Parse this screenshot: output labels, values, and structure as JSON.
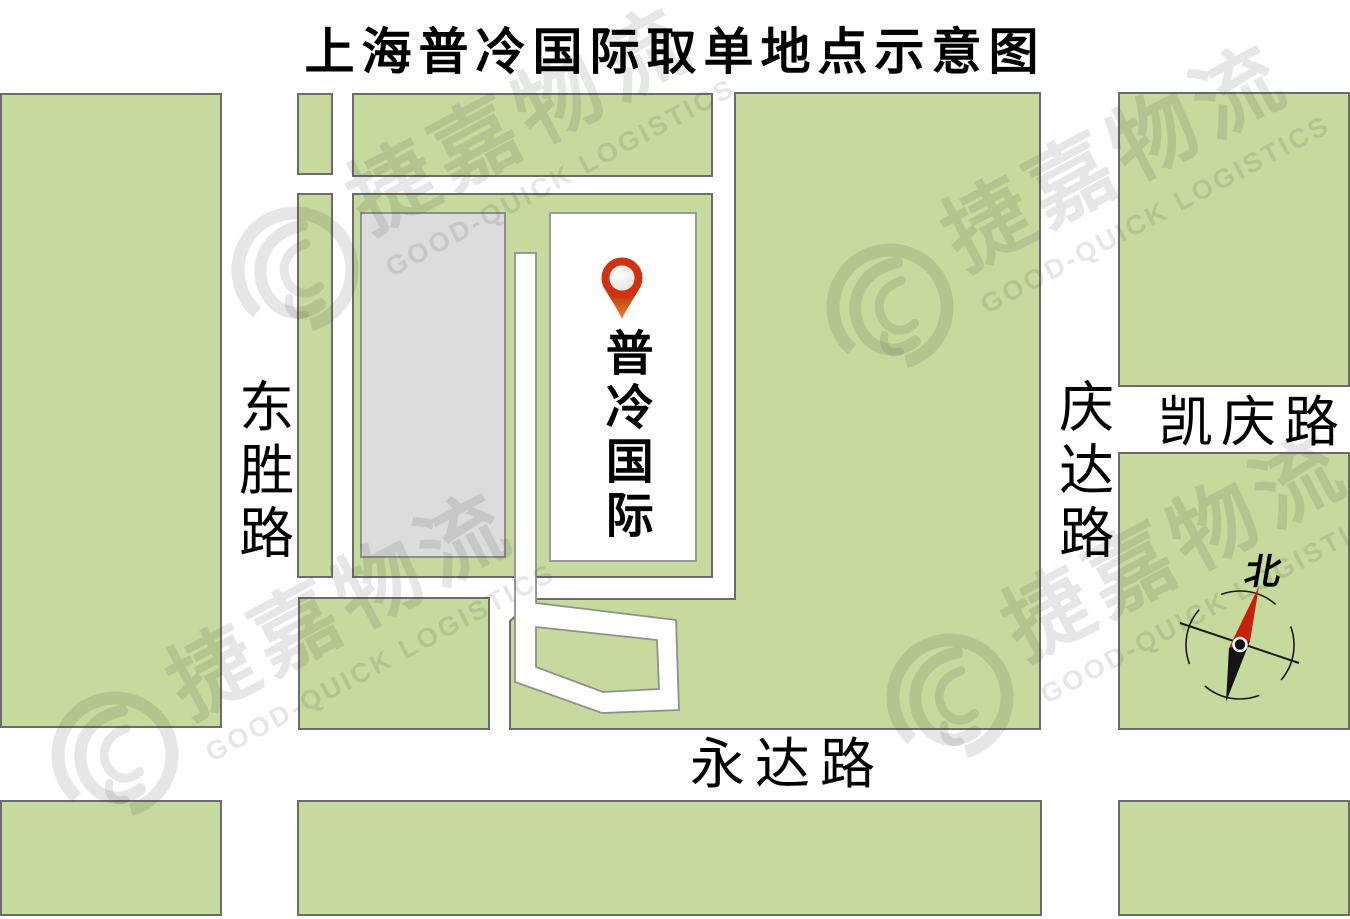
{
  "title": "上海普冷国际取单地点示意图",
  "roads": {
    "west": "东胜路",
    "east": "庆达路",
    "northeast": "凯庆路",
    "south": "永达路"
  },
  "facility": {
    "name": "普冷国际",
    "marker": "location-pin"
  },
  "compass": {
    "north_label": "北"
  },
  "watermark": {
    "cn": "捷嘉物流",
    "en": "GOOD-QUICK LOGISTICS"
  },
  "colors": {
    "block_green": "#c5da9c",
    "block_border": "#6b6b6b",
    "building_gray": "#dcdcdc",
    "road_white": "#ffffff",
    "pin_red": "#d2310e",
    "pin_orange": "#f08428",
    "needle_red": "#c8200d",
    "needle_black": "#141414"
  }
}
